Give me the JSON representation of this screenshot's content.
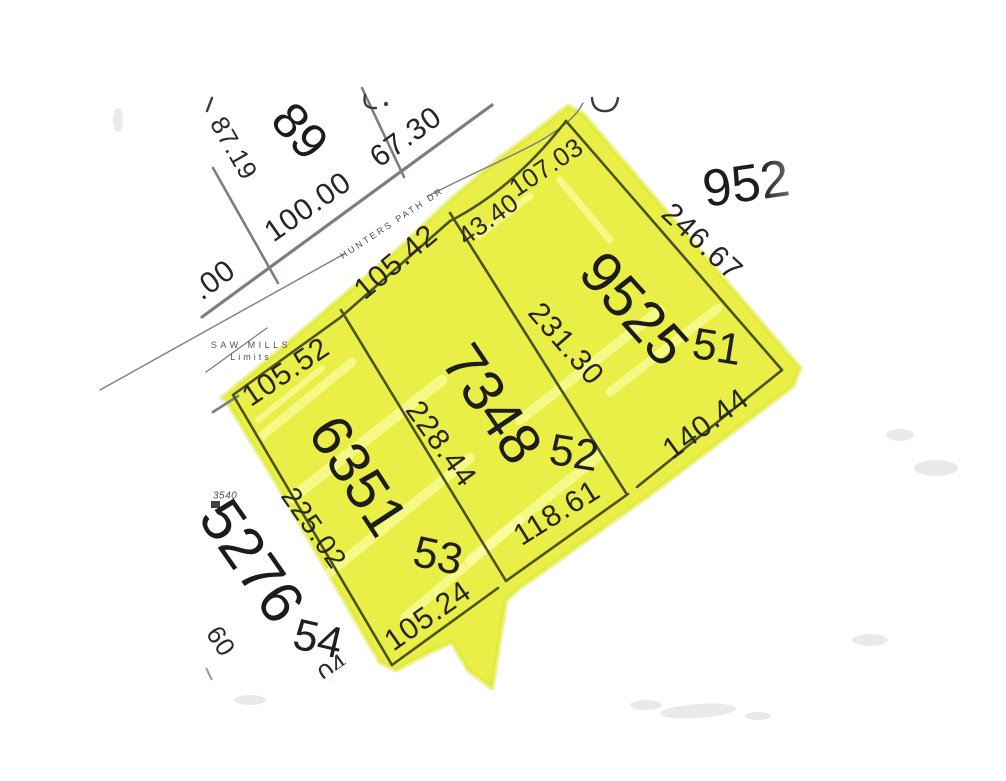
{
  "street": {
    "name": "HUNTERS PATH DR"
  },
  "boundary_label": {
    "line1": "SAW MILLS",
    "line2": "Limits"
  },
  "highlighted_block": {
    "lot51": {
      "lot_number": "51",
      "parcel_number": "9525",
      "front_dim_a": "43.40",
      "front_dim_b": "107.03",
      "northeast_dim": "246.67",
      "rear_dim": "140.44",
      "southwest_dim": "231.30"
    },
    "lot52": {
      "lot_number": "52",
      "parcel_number": "7348",
      "front_dim": "105.42",
      "rear_dim": "118.61",
      "southwest_dim": "228.44"
    },
    "lot53": {
      "lot_number": "53",
      "parcel_number": "6351",
      "front_dim": "105.52",
      "rear_dim": "105.24",
      "southwest_dim": "225.02"
    }
  },
  "adjacent": {
    "lot89": {
      "lot_number": "89",
      "dim_a": "87.19",
      "dim_b": "100.00",
      "dim_c": "67.30",
      "partial_dim": ".00"
    },
    "parcel_northeast": {
      "parcel_number": "952"
    },
    "lot54": {
      "lot_number": "54",
      "parcel_number": "5276",
      "partial_dim_a": "60",
      "partial_dim_b": "04"
    },
    "reference_marker": {
      "id": "3540"
    }
  },
  "colors": {
    "highlight": "#e9ef46",
    "lot_line": "#4a541e",
    "survey_line": "#7b807b",
    "text": "#1f1f1f"
  }
}
